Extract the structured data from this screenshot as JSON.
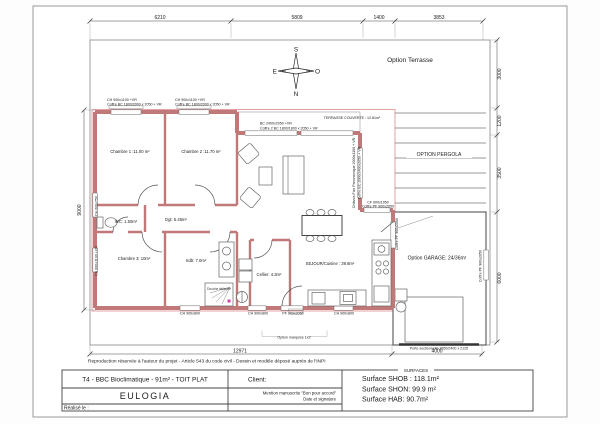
{
  "compass": {
    "s": "S",
    "e": "E",
    "o": "O",
    "n": "N"
  },
  "options": {
    "terrasse": "Option Terrasse",
    "terrasse_couverte": "TERRASSE COUVERTE : 12.81m²",
    "pergola": "OPTION PERGOLA",
    "garage": "Option GARAGE: 24/36m²",
    "marquise": "Option marquise 1x2"
  },
  "dims": {
    "top1": "6210",
    "top2": "5809",
    "top3": "1400",
    "top4": "3853",
    "right1": "3000",
    "right2": "1200",
    "right3": "3500",
    "right4": "6000",
    "left1": "9000",
    "bottom1": "12971",
    "bottom2": "4000"
  },
  "rooms": {
    "chambre1": "Chambre 1 :11.00 m²",
    "chambre2": "Chambre 2 :11.70 m²",
    "chambre3": "Chambre 3: 10m²",
    "wc": "WC: 1.50m²",
    "dgt": "Dgt: 5.45m²",
    "sdb": "Sdb: 7.0m²",
    "cellier": "Cellier: 4.3m²",
    "sejour": "SEJOUR/Cuisine : 39.8m²",
    "douche": "Douche italienne"
  },
  "windows": {
    "ch1_l1": "CH 900x1100 +VR",
    "ch1_l2": "Coffre BC 1800/2000 x 2050 + VR",
    "ch2_l1": "CH 900x1100 +VR",
    "ch2_l2": "Coffre BC 1800/2000 x 2050 + VR",
    "bc_l1": "BC 2400x2050 +VR",
    "bc_l2": "Coffre 2 BC 1800/1800 x 2050 + VR",
    "fixe_l1": "Châssis Fixe Panoramique 2000x1100 + VR",
    "fixe_l2": "Coffre BC 2000/2400x2050 + VR",
    "cf_l1": "CF 900x1950",
    "cf_l2": "Coffre PF 900x2050",
    "pf_garage": "Coffre PF 900x2050",
    "pf_garage_r": "Coffre PF 900x2050",
    "left1": "CH 600x750",
    "left2": "CH 600x1100 +VR",
    "bottom1": "CH 900x800",
    "bottom2": "CH 900x800",
    "bottom3": "PF 900x2050",
    "bottom4": "CH 900x800",
    "porte_garage": "Porte sectionnelle 2950/2400 x 2125"
  },
  "footer": {
    "disclaimer": "Reproduction réservée à l'auteur du projet - Article 543 du code civil - Dessin et modèle déposé auprès de l'INPI"
  },
  "titleblock": {
    "project": "T4  - BBC Bioclimatique - 91m² - TOIT PLAT",
    "client_label": "Client:",
    "company": "EULOGIA",
    "mention": "Mention manuscrite \"Bon pour accord\"",
    "date_sig": "Date et signature",
    "realise": "Réalisé le :",
    "surfaces_title": "SURFACES",
    "shob": "Surface SHOB : 118.1m²",
    "shon": "Surface SHON: 99.9 m²",
    "hab": "Surface HAB: 90.7m²"
  }
}
